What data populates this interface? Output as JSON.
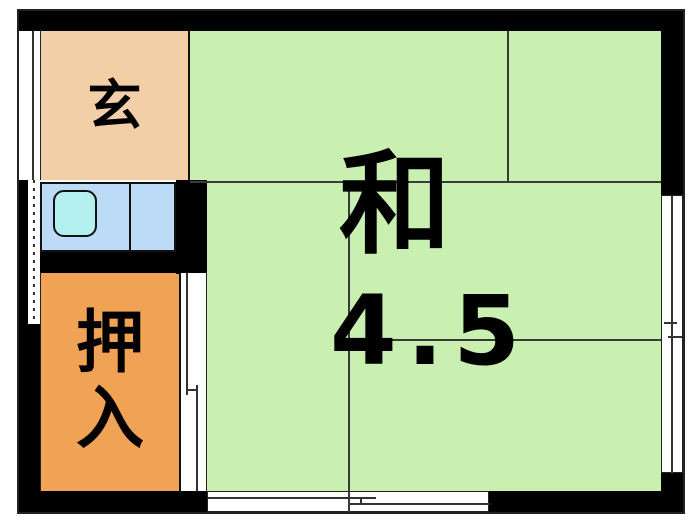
{
  "plan": {
    "rooms": {
      "entrance": {
        "label": "玄"
      },
      "closet": {
        "label_char1": "押",
        "label_char2": "入"
      },
      "main_room": {
        "type_label": "和",
        "size_label": "4.5"
      }
    },
    "colors": {
      "wall": "#000000",
      "entrance_bg": "#f2cfa6",
      "kitchen_bg": "#bcdbf6",
      "sink_bg": "#b5f0f0",
      "closet_bg": "#f0a355",
      "room_bg": "#c9f0b0"
    }
  }
}
